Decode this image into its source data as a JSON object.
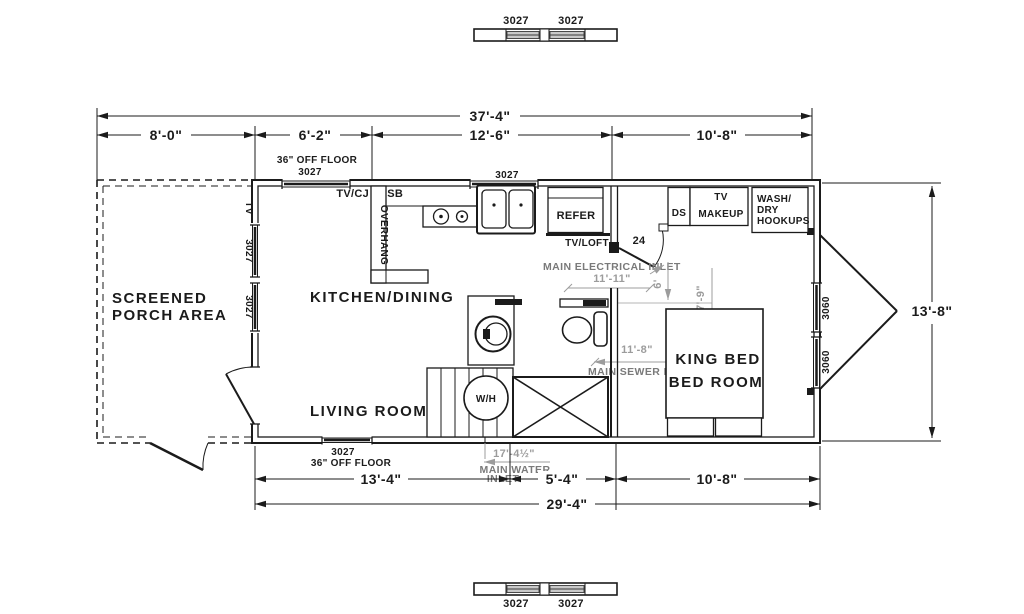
{
  "plan": {
    "rooms": {
      "porch_line1": "SCREENED",
      "porch_line2": "PORCH AREA",
      "kitchen_dining": "KITCHEN/DINING",
      "living_room": "LIVING ROOM",
      "bedroom_line1": "KING BED",
      "bedroom_line2": "BED ROOM"
    },
    "windows": {
      "w3027": "3027",
      "w3060": "3060",
      "off_floor_note": "36\" OFF FLOOR"
    },
    "fixtures": {
      "tv_cj": "TV/CJ",
      "usb": "USB",
      "overhang": "OVERHANG",
      "refer": "REFER",
      "tv_loft": "TV/LOFT",
      "ds": "DS",
      "tv": "TV",
      "makeup": "MAKEUP",
      "wash": "WASH/",
      "dry": "DRY",
      "hookups": "HOOKUPS",
      "water_heater": "W/H",
      "porch_tv": "TV",
      "door_size": "24"
    },
    "dims": {
      "overall_top": "37'-4\"",
      "porch_w": "8'-0\"",
      "seg_6_2": "6'-2\"",
      "seg_12_6": "12'-6\"",
      "seg_10_8": "10'-8\"",
      "right_h": "13'-8\"",
      "bot_13_4": "13'-4\"",
      "bot_5_4": "5'-4\"",
      "bot_10_8": "10'-8\"",
      "overall_bottom": "29'-4\""
    },
    "utility_dims": {
      "electrical_x": "11'-11\"",
      "electrical_y": "6'",
      "bed_clear": "7'-9\"",
      "sewer_x": "11'-8\"",
      "water_x": "17'-4½\""
    },
    "notes": {
      "electrical": "MAIN ELECTRICAL INLET",
      "sewer": "MAIN SEWER DROP",
      "water_line1": "MAIN WATER",
      "water_line2": "INLET"
    },
    "colors": {
      "line": "#1b1b1b",
      "annotation_gray": "#9c9c9c",
      "note_gray": "#7a7a7a",
      "glass_fill": "#c9c9c9"
    }
  }
}
